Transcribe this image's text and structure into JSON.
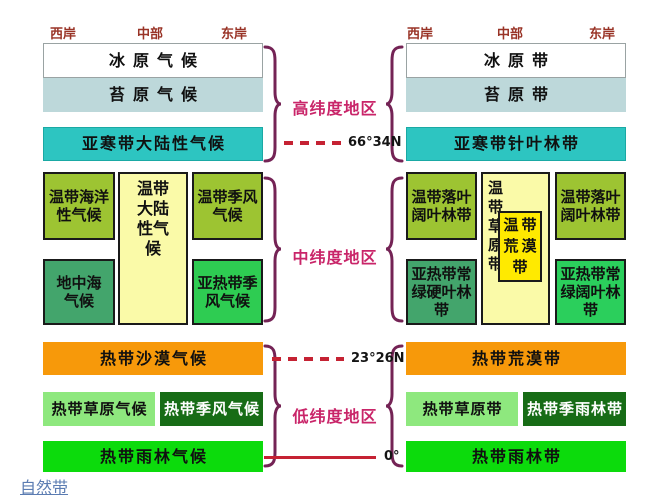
{
  "coast_headers": {
    "left": [
      {
        "label": "西岸"
      },
      {
        "label": "中部"
      },
      {
        "label": "东岸"
      }
    ],
    "right": [
      {
        "label": "西岸"
      },
      {
        "label": "中部"
      },
      {
        "label": "东岸"
      }
    ],
    "color": "#993326"
  },
  "climate_column": {
    "ice": {
      "label": "冰原气候",
      "color": "#ffffff"
    },
    "tundra": {
      "label": "苔原气候",
      "color": "#bdd8da"
    },
    "subarctic": {
      "label": "亚寒带大陆性气候",
      "color": "#2dc5c1"
    },
    "temperate_oceanic": {
      "label": "温带海洋\n性气候",
      "color": "#9dc432"
    },
    "temperate_continental": {
      "label": "温带\n大陆\n性气\n候",
      "color": "#fafaa8"
    },
    "temperate_monsoon": {
      "label": "温带季风\n气候",
      "color": "#9dc432"
    },
    "mediterranean": {
      "label": "地中海\n气候",
      "color": "#43a56c"
    },
    "subtropical_monsoon": {
      "label": "亚热带季\n风气候",
      "color": "#2ecc52"
    },
    "tropical_desert": {
      "label": "热带沙漠气候",
      "color": "#f7990a"
    },
    "tropical_grassland": {
      "label": "热带草原气候",
      "color": "#8ee87e"
    },
    "tropical_monsoon": {
      "label": "热带季风气候",
      "color": "#176c16",
      "text_color": "#ffffff"
    },
    "tropical_rainforest": {
      "label": "热带雨林气候",
      "color": "#0cdb0c"
    }
  },
  "belt_column": {
    "ice": {
      "label": "冰原带",
      "color": "#ffffff"
    },
    "tundra": {
      "label": "苔原带",
      "color": "#bdd8da"
    },
    "taiga": {
      "label": "亚寒带针叶林带",
      "color": "#2dc5c1"
    },
    "deciduous_west": {
      "label": "温带落叶\n阔叶林带",
      "color": "#9dc432"
    },
    "steppe": {
      "label": "温\n带\n草\n原\n带",
      "color": "#fafaa8"
    },
    "temperate_desert": {
      "label": "温带\n荒漠\n带",
      "color": "#ffea00"
    },
    "deciduous_east": {
      "label": "温带落叶\n阔叶林带",
      "color": "#9dc432"
    },
    "sclerophyll": {
      "label": "亚热带常\n绿硬叶林\n带",
      "color": "#43a56c"
    },
    "evergreen_broadleaf": {
      "label": "亚热带常\n绿阔叶林\n带",
      "color": "#2bcf5c"
    },
    "tropical_desert": {
      "label": "热带荒漠带",
      "color": "#f7990a"
    },
    "tropical_grassland": {
      "label": "热带草原带",
      "color": "#8ee87e"
    },
    "seasonal_rainforest": {
      "label": "热带季雨林带",
      "color": "#176c16",
      "text_color": "#ffffff"
    },
    "tropical_rainforest": {
      "label": "热带雨林带",
      "color": "#0cdb0c"
    }
  },
  "center": {
    "high_latitude_label": "高纬度地区",
    "mid_latitude_label": "中纬度地区",
    "low_latitude_label": "低纬度地区",
    "arctic_circle_label": "66°34N",
    "tropic_label": "23°26N",
    "equator_label": "0°",
    "zone_label_color": "#c92569",
    "line_color": "#c52233",
    "brace_color": "#742355"
  },
  "footer": {
    "natural_belt_link": "自然带",
    "link_color": "#5b7cb2"
  }
}
